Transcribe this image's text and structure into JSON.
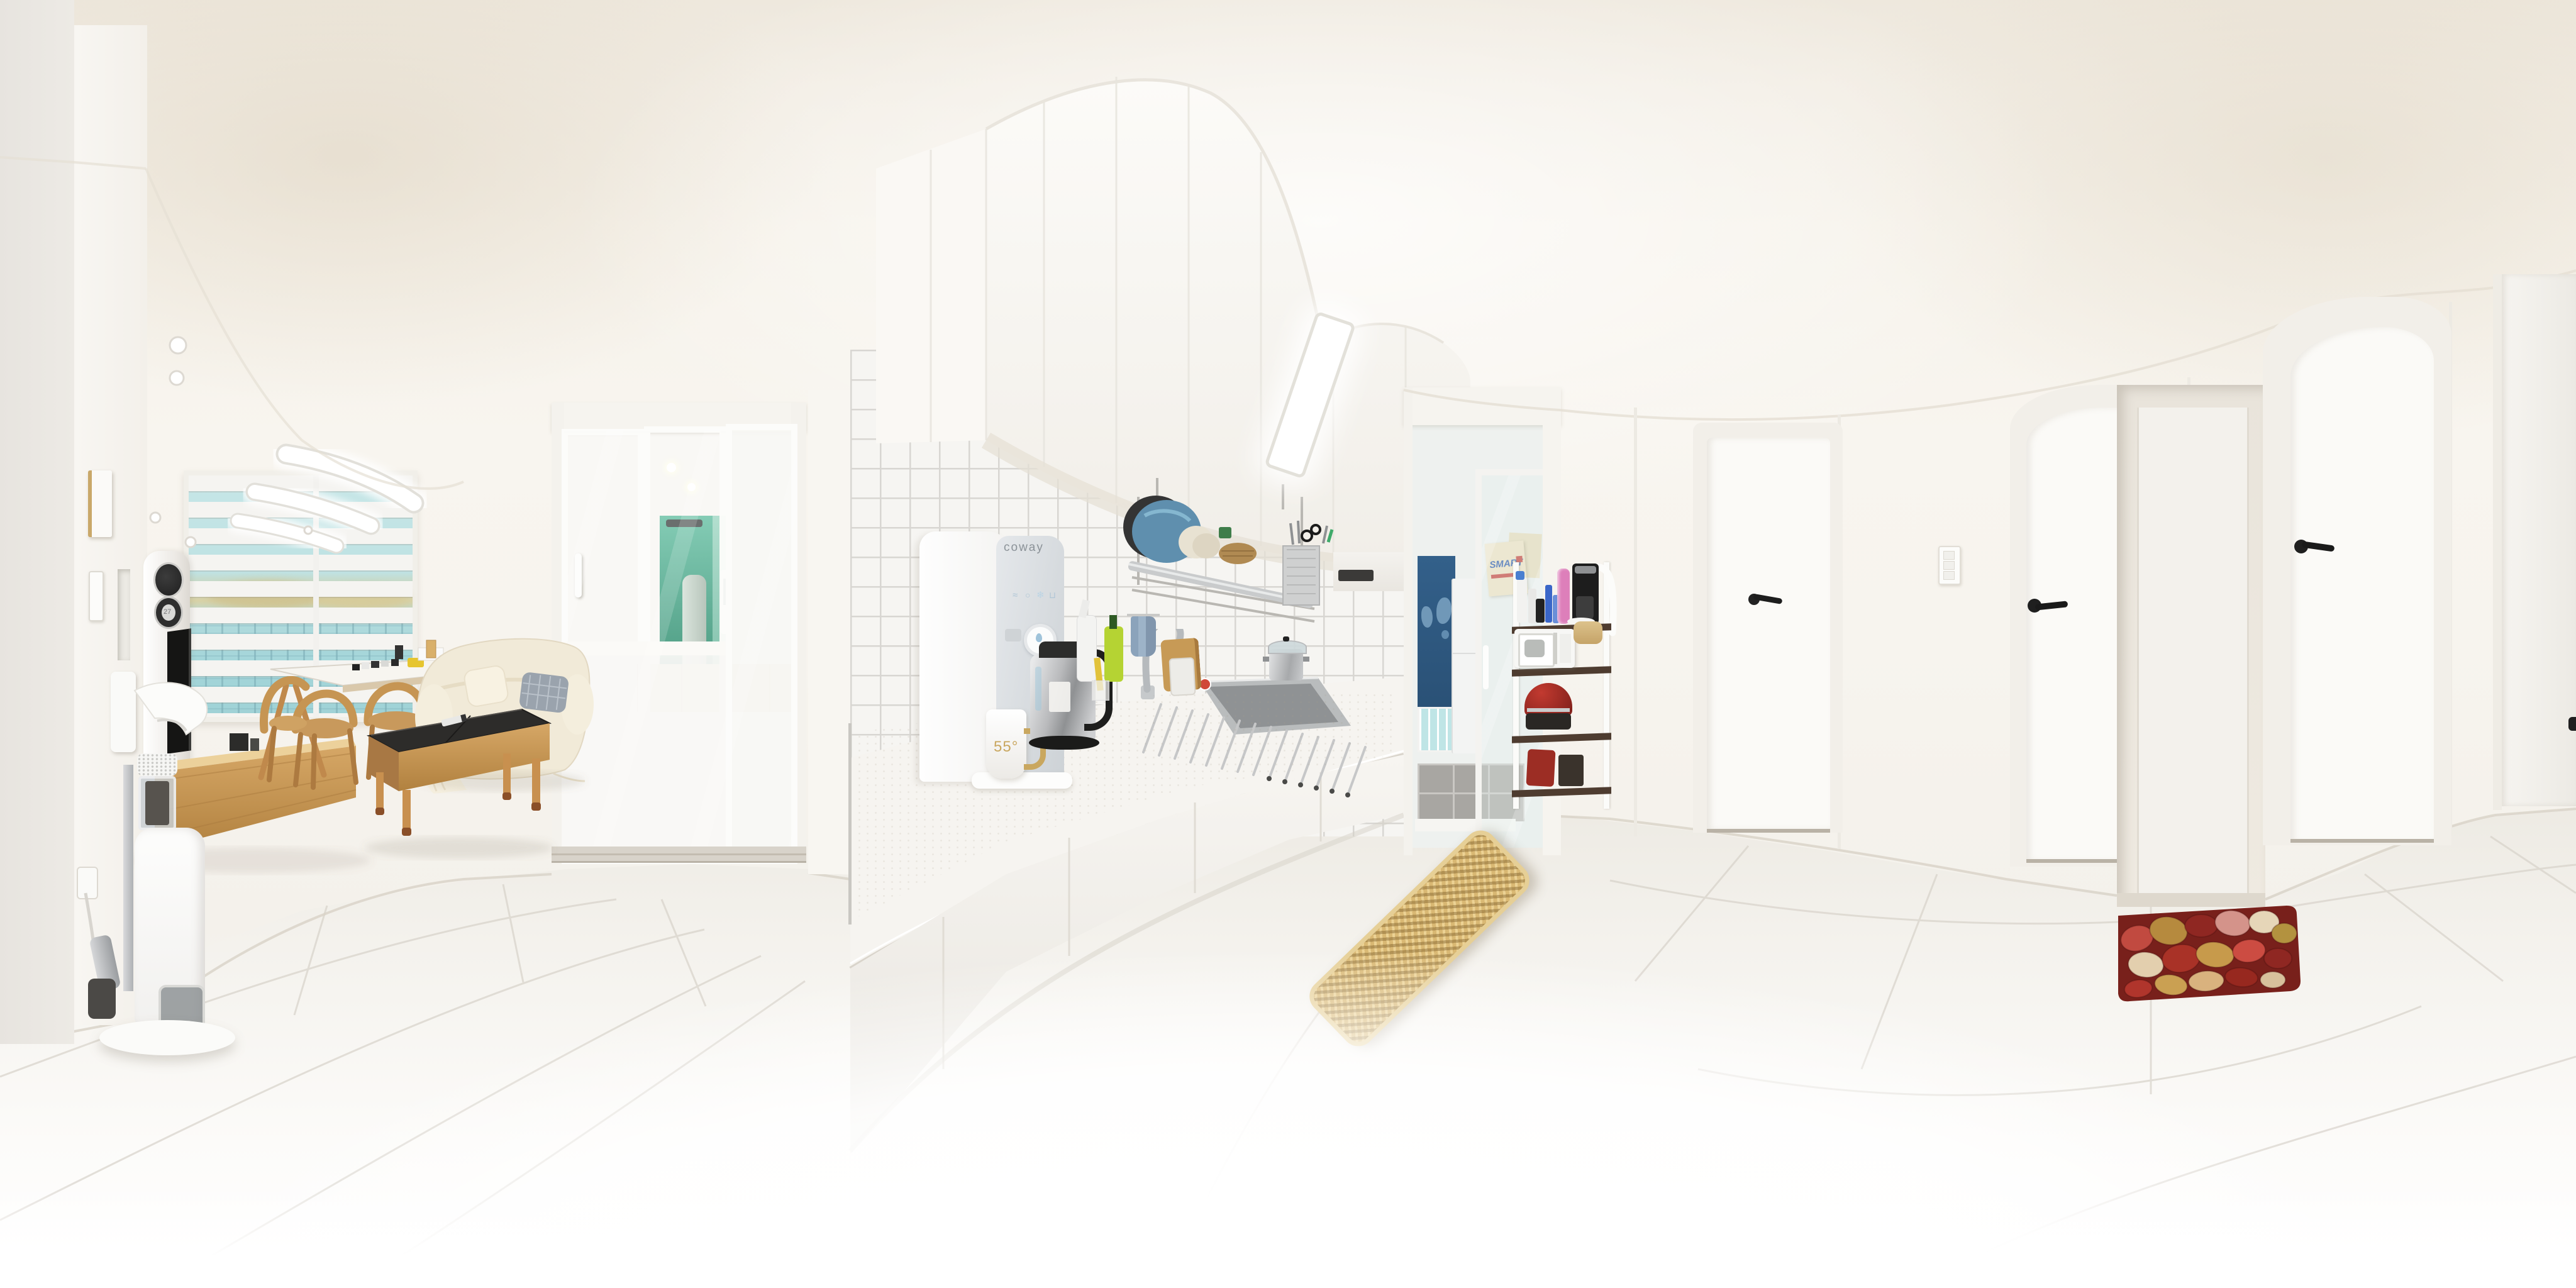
{
  "scene": {
    "type": "equirectangular-360-photo",
    "location": "apartment-interior",
    "areas": [
      "living-room",
      "entry-vestibule",
      "kitchen",
      "utility-balcony",
      "hallway",
      "entrance"
    ]
  },
  "texts": {
    "purifier_brand": "coway",
    "mug_label": "55°",
    "box_sign": "SMART",
    "ac_display": "27"
  },
  "icons": {
    "purifier_hot": "≈",
    "purifier_pure": "○",
    "purifier_cold": "❄",
    "purifier_cup": "⊔"
  },
  "palette": {
    "wall": "#f6f3ed",
    "ceiling": "#f2ede4",
    "floor": "#f3f1ec",
    "wood": "#c9945a",
    "sofa": "#f2ebd9",
    "counter": "#f1eee7",
    "tile_grout": "#d8d6d2",
    "blue_wall": "#33608a",
    "teal_glass": "#a9dade",
    "mat_tan": "#d9b873",
    "mat_red": "#7a201c",
    "handle_black": "#222222"
  },
  "objects": [
    "ceiling-led-lights",
    "recessed-spotlights",
    "window-blinds",
    "air-conditioner-tower",
    "television",
    "tv-console",
    "cordless-vacuum",
    "dining-table",
    "dining-chairs",
    "sofa",
    "throw-pillows",
    "coffee-table",
    "remote-control",
    "sliding-glass-door",
    "entry-vestibule",
    "green-glass-partition",
    "water-purifier",
    "mug",
    "electric-kettle",
    "dish-rack",
    "plates",
    "utensil-holder",
    "kitchen-sink",
    "faucet",
    "rolling-drying-rack",
    "cutting-boards",
    "dish-soap",
    "stock-pot",
    "range-hood",
    "kitchen-cabinets",
    "kitchen-floor-mat",
    "balcony-doorway",
    "world-map-roller-blind",
    "refrigerator",
    "storage-rack",
    "microwave",
    "coffee-maker",
    "rice-cooker",
    "paper-towel-roll",
    "hallway-doors",
    "door-handles",
    "light-switch",
    "entrance-recess",
    "pebble-doormat",
    "smoke-detector",
    "wall-intercom",
    "power-outlet"
  ]
}
